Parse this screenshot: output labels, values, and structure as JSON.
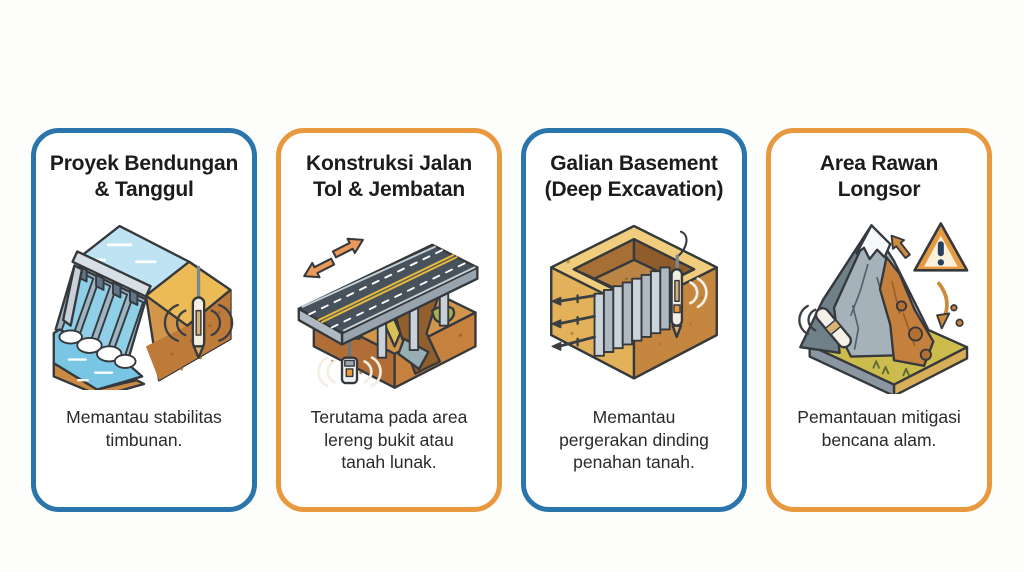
{
  "page": {
    "background_color": "#FDFDFB",
    "card_background": "#FFFFFF",
    "title_color": "#1C1C1E",
    "body_text_color": "#2A2A2C"
  },
  "accents": {
    "blue": "#2A76AC",
    "orange": "#E8993E"
  },
  "cards": [
    {
      "id": "dam",
      "accent_color": "#2A76AC",
      "title": "Proyek Bendungan & Tanggul",
      "description": "Memantau stabilitas timbunan.",
      "illustration": "dam-and-embankment-with-sensor",
      "icons": [
        "dam-spillway",
        "reservoir-water",
        "embankment-soil",
        "sensor-probe-icon",
        "signal-waves-icon"
      ]
    },
    {
      "id": "highway",
      "accent_color": "#E8993E",
      "title": "Konstruksi Jalan Tol & Jembatan",
      "description": "Terutama pada area lereng bukit atau tanah lunak.",
      "illustration": "elevated-highway-bridge-with-sensor",
      "icons": [
        "movement-arrows-icon",
        "road-deck",
        "bridge-piers",
        "ravine-terrain",
        "sensor-device-icon",
        "signal-waves-icon"
      ]
    },
    {
      "id": "excavation",
      "accent_color": "#2A76AC",
      "title": "Galian Basement (Deep Excavation)",
      "description": "Memantau pergerakan dinding penahan tanah.",
      "illustration": "deep-excavation-pit-with-retaining-wall-and-sensor",
      "icons": [
        "sheet-pile-wall",
        "ground-anchors",
        "sensor-probe-icon",
        "signal-waves-icon"
      ]
    },
    {
      "id": "landslide",
      "accent_color": "#E8993E",
      "title": "Area Rawan Longsor",
      "description": "Pemantauan mitigasi bencana alam.",
      "illustration": "landslide-prone-mountain-with-sensor",
      "icons": [
        "warning-triangle-icon",
        "movement-arrows-icon",
        "falling-rocks",
        "sensor-probe-icon",
        "signal-waves-icon"
      ]
    }
  ]
}
